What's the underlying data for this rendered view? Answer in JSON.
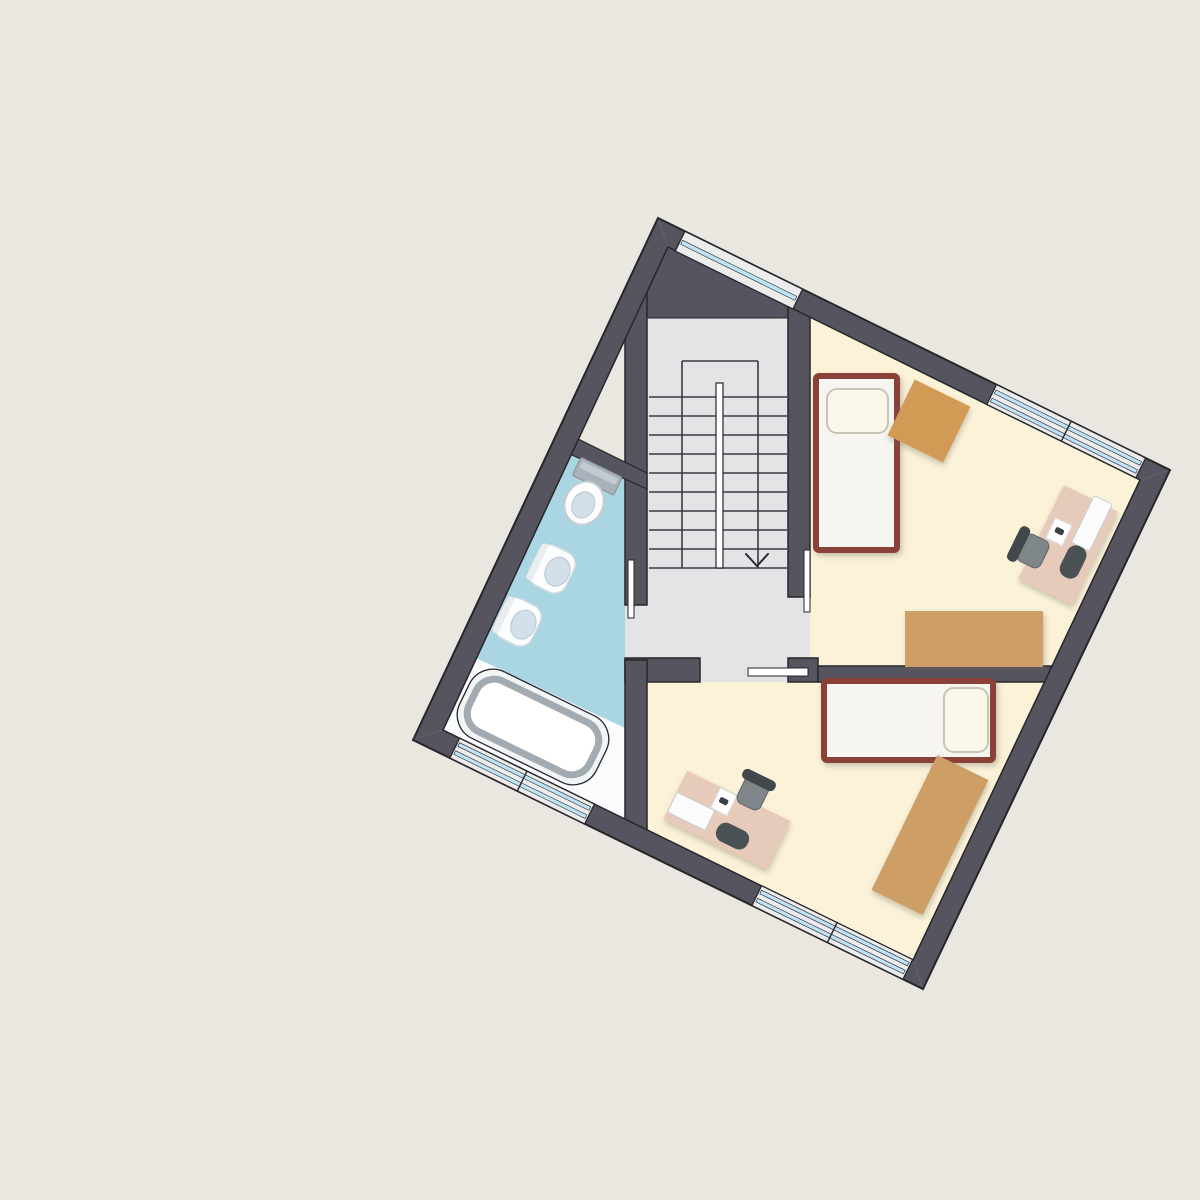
{
  "scene": {
    "width": 1200,
    "height": 1200,
    "background": "#eae7e1",
    "rotation_deg": 26
  },
  "palette": {
    "background": "#eae7e1",
    "wall": "#56545e",
    "outline": "#26262c",
    "hall_floor": "#e4e4e6",
    "stair_line": "#3a3a40",
    "bath_floor": "#aad6e4",
    "bath_platform": "#fafbfc",
    "bedroom_floor": "#fbf2d8",
    "window_band": "#ececec",
    "window_glass": "#bfe3f4",
    "bed_frame": "#8a4237",
    "bed_fill": "#f7f5f0",
    "pillow": "#fbf8ea",
    "cabinet_tan": "#cd9e66",
    "table_tan": "#d19a55",
    "desk_pink": "#e6cbbb",
    "chair_dark": "#41474a",
    "chair_seat": "#7e8689",
    "device_white": "#fbfbfb",
    "fixture_white": "#fcfdfe",
    "fixture_bowl": "#d3dfe9",
    "tank_gray": "#a9b2ba",
    "tub_rim": "#a3abb2"
  },
  "rooms": [
    {
      "id": "stair-hall"
    },
    {
      "id": "bathroom"
    },
    {
      "id": "bedroom-1"
    },
    {
      "id": "bedroom-2"
    }
  ],
  "shapes": [
    {
      "type": "polygon",
      "name": "hall-floor",
      "points": "647,318 779,318 810,334 810,682 625,682 625,605 647,605",
      "fill": "#e4e4e6"
    },
    {
      "type": "polygon",
      "name": "bathroom-floor",
      "points": "575,448 625,472 625,819 443,730",
      "fill": "#aad6e4"
    },
    {
      "type": "polygon",
      "name": "bathroom-platform",
      "points": "476,658 625,728 625,819 443,730",
      "fill": "#fafbfc"
    },
    {
      "type": "polygon",
      "name": "bedroom1-floor",
      "points": "810,316 1140,480 1049,672 810,672",
      "fill": "#fbf2d8"
    },
    {
      "type": "polygon",
      "name": "bedroom2-floor",
      "points": "647,682 1044,682 913,960 647,830",
      "fill": "#fbf2d8"
    },
    {
      "type": "line",
      "name": "stair-step",
      "x1": 649,
      "y1": 397,
      "x2": 787,
      "y2": 397,
      "stroke": "#3a3a40",
      "sw": 1.6
    },
    {
      "type": "line",
      "name": "stair-step",
      "x1": 649,
      "y1": 416,
      "x2": 787,
      "y2": 416,
      "stroke": "#3a3a40",
      "sw": 1.6
    },
    {
      "type": "line",
      "name": "stair-step",
      "x1": 649,
      "y1": 435,
      "x2": 787,
      "y2": 435,
      "stroke": "#3a3a40",
      "sw": 1.6
    },
    {
      "type": "line",
      "name": "stair-step",
      "x1": 649,
      "y1": 454,
      "x2": 787,
      "y2": 454,
      "stroke": "#3a3a40",
      "sw": 1.6
    },
    {
      "type": "line",
      "name": "stair-step",
      "x1": 649,
      "y1": 473,
      "x2": 787,
      "y2": 473,
      "stroke": "#3a3a40",
      "sw": 1.6
    },
    {
      "type": "line",
      "name": "stair-step",
      "x1": 649,
      "y1": 492,
      "x2": 787,
      "y2": 492,
      "stroke": "#3a3a40",
      "sw": 1.6
    },
    {
      "type": "line",
      "name": "stair-step",
      "x1": 649,
      "y1": 511,
      "x2": 787,
      "y2": 511,
      "stroke": "#3a3a40",
      "sw": 1.6
    },
    {
      "type": "line",
      "name": "stair-step",
      "x1": 649,
      "y1": 530,
      "x2": 787,
      "y2": 530,
      "stroke": "#3a3a40",
      "sw": 1.6
    },
    {
      "type": "line",
      "name": "stair-step",
      "x1": 649,
      "y1": 549,
      "x2": 787,
      "y2": 549,
      "stroke": "#3a3a40",
      "sw": 1.6
    },
    {
      "type": "line",
      "name": "stair-step",
      "x1": 649,
      "y1": 568,
      "x2": 787,
      "y2": 568,
      "stroke": "#3a3a40",
      "sw": 1.6
    },
    {
      "type": "line",
      "name": "stair-well-left",
      "x1": 682,
      "y1": 361,
      "x2": 682,
      "y2": 568,
      "stroke": "#3a3a40",
      "sw": 1.6
    },
    {
      "type": "line",
      "name": "stair-well-right",
      "x1": 758,
      "y1": 361,
      "x2": 758,
      "y2": 568,
      "stroke": "#3a3a40",
      "sw": 1.6
    },
    {
      "type": "line",
      "name": "stair-landing-edge",
      "x1": 682,
      "y1": 361,
      "x2": 758,
      "y2": 361,
      "stroke": "#3a3a40",
      "sw": 1.6
    },
    {
      "type": "rect",
      "name": "stair-handrail",
      "x": 716,
      "y": 383,
      "w": 7,
      "h": 185,
      "fill": "#ffffff",
      "stroke": "#26262c",
      "sw": 1.2
    },
    {
      "type": "polyline",
      "name": "stair-direction-arrow",
      "points": "746,554 757,566 768,554",
      "stroke": "#26262c",
      "sw": 2
    },
    {
      "type": "polygon",
      "name": "wall-top-corner-block",
      "points": "640,318 790,318 790,304 672,241 640,289",
      "fill": "#56545e",
      "stroke": "#26262c",
      "sw": 1
    },
    {
      "type": "rect",
      "name": "wall-hall-bathroom",
      "x": 625,
      "y": 294,
      "w": 22,
      "h": 311,
      "fill": "#56545e",
      "stroke": "#26262c",
      "sw": 1.5
    },
    {
      "type": "rect",
      "name": "wall-hall-bedroom1",
      "x": 788,
      "y": 304,
      "w": 22,
      "h": 293,
      "fill": "#56545e",
      "stroke": "#26262c",
      "sw": 1.5
    },
    {
      "type": "rect",
      "name": "wall-hall-bedroom2-left",
      "x": 625,
      "y": 658,
      "w": 75,
      "h": 24,
      "fill": "#56545e",
      "stroke": "#26262c",
      "sw": 1.5
    },
    {
      "type": "rect",
      "name": "wall-hall-bedroom2-corner",
      "x": 788,
      "y": 658,
      "w": 30,
      "h": 24,
      "fill": "#56545e",
      "stroke": "#26262c",
      "sw": 1.5
    },
    {
      "type": "rect",
      "name": "wall-bedroom1-bedroom2",
      "x": 818,
      "y": 666,
      "w": 247,
      "h": 16,
      "fill": "#56545e",
      "stroke": "#26262c",
      "sw": 1.5
    },
    {
      "type": "rect",
      "name": "wall-bathroom-bedroom2",
      "x": 625,
      "y": 660,
      "w": 22,
      "h": 175,
      "fill": "#56545e",
      "stroke": "#26262c",
      "sw": 1.5
    },
    {
      "type": "polygon",
      "name": "wall-bathroom-top",
      "points": "560,430 647,473 647,489 552,446",
      "fill": "#56545e",
      "stroke": "#26262c",
      "sw": 1.2
    },
    {
      "type": "polygon",
      "name": "outer-wall-top-right",
      "points": "658,218 1170,470 1140,480 668,247",
      "fill": "#56545e"
    },
    {
      "type": "polygon",
      "name": "outer-wall-right",
      "points": "1170,470 923,989 913,960 1140,480",
      "fill": "#56545e"
    },
    {
      "type": "polygon",
      "name": "outer-wall-bottom-left",
      "points": "923,989 413,740 443,730 913,960",
      "fill": "#56545e"
    },
    {
      "type": "polygon",
      "name": "outer-wall-top-left",
      "points": "413,740 658,218 668,247 443,730",
      "fill": "#56545e"
    },
    {
      "type": "polygon",
      "name": "outer-wall-outline",
      "points": "658,218 1170,470 923,989 413,740",
      "fill": "none",
      "stroke": "#26262c",
      "sw": 2
    },
    {
      "type": "polygon",
      "name": "inner-wall-outline",
      "points": "668,247 1140,480 913,960 443,730",
      "fill": "none",
      "stroke": "#26262c",
      "sw": 1.5
    },
    {
      "type": "polygon",
      "name": "window-hall-band",
      "points": "684.9,231.3 802.6,289.2 792.9,309.0 675.2,251.1",
      "fill": "#ececec",
      "stroke": "#26262c",
      "sw": 1.3
    },
    {
      "type": "polygon",
      "name": "window-hall-glass",
      "points": "682.7,240.3 796.8,296.4 794.8,300.4 680.7,244.3",
      "fill": "#bfe3f4",
      "stroke": "#26262c",
      "sw": 0.6
    },
    {
      "type": "polygon",
      "name": "window-bedroom1-band",
      "points": "996.5,384.6 1145.6,458.0 1135.9,477.8 986.8,404.4",
      "fill": "#ececec",
      "stroke": "#26262c",
      "sw": 1.3
    },
    {
      "type": "polygon",
      "name": "window-bedroom1-glass-outer",
      "points": "996.1,390.0 1141.6,461.6 1139.8,465.2 994.3,393.6",
      "fill": "#bfe3f4",
      "stroke": "#26262c",
      "sw": 0.6
    },
    {
      "type": "polygon",
      "name": "window-bedroom1-glass-inner",
      "points": "992.1,398.1 1137.6,469.7 1135.8,473.3 990.3,401.7",
      "fill": "#bfe3f4",
      "stroke": "#26262c",
      "sw": 0.6
    },
    {
      "type": "line",
      "name": "window-bedroom1-mullion",
      "x1": 1071.1,
      "y1": 421.3,
      "x2": 1061.4,
      "y2": 441.1,
      "stroke": "#26262c",
      "sw": 1.4
    },
    {
      "type": "polygon",
      "name": "window-bathroom-band",
      "points": "449.9,758.0 584.7,823.9 594.4,804.1 459.6,738.2",
      "fill": "#ececec",
      "stroke": "#26262c",
      "sw": 1.3
    },
    {
      "type": "polygon",
      "name": "window-bathroom-glass-outer",
      "points": "453.9,754.4 585.1,818.5 586.9,814.9 455.7,750.8",
      "fill": "#bfe3f4",
      "stroke": "#26262c",
      "sw": 0.6
    },
    {
      "type": "polygon",
      "name": "window-bathroom-glass-inner",
      "points": "457.8,746.3 589.0,810.4 590.8,806.8 459.6,742.7",
      "fill": "#bfe3f4",
      "stroke": "#26262c",
      "sw": 0.6
    },
    {
      "type": "line",
      "name": "window-bathroom-mullion",
      "x1": 517.3,
      "y1": 790.9,
      "x2": 527.0,
      "y2": 771.1,
      "stroke": "#26262c",
      "sw": 1.4
    },
    {
      "type": "polygon",
      "name": "window-bedroom2-band",
      "points": "751.9,905.5 903.0,979.3 912.7,959.5 761.6,885.7",
      "fill": "#ececec",
      "stroke": "#26262c",
      "sw": 1.3
    },
    {
      "type": "polygon",
      "name": "window-bedroom2-glass-outer",
      "points": "755.9,901.9 903.4,973.9 905.2,970.3 757.7,898.3",
      "fill": "#bfe3f4",
      "stroke": "#26262c",
      "sw": 0.6
    },
    {
      "type": "polygon",
      "name": "window-bedroom2-glass-inner",
      "points": "759.8,893.8 907.3,965.8 909.1,962.2 761.6,890.2",
      "fill": "#bfe3f4",
      "stroke": "#26262c",
      "sw": 0.6
    },
    {
      "type": "line",
      "name": "window-bedroom2-mullion",
      "x1": 827.4,
      "y1": 942.4,
      "x2": 837.1,
      "y2": 922.6,
      "stroke": "#26262c",
      "sw": 1.4
    },
    {
      "type": "rect",
      "name": "door-jamb-bathroom",
      "x": 628,
      "y": 560,
      "w": 6,
      "h": 58,
      "fill": "#ffffff",
      "stroke": "#26262c",
      "sw": 1
    },
    {
      "type": "rect",
      "name": "door-jamb-bedroom1",
      "x": 804,
      "y": 550,
      "w": 6,
      "h": 62,
      "fill": "#ffffff",
      "stroke": "#26262c",
      "sw": 1
    },
    {
      "type": "rect",
      "name": "door-leaf-bedroom2",
      "x": 748,
      "y": 668,
      "w": 60,
      "h": 8,
      "fill": "#ffffff",
      "stroke": "#26262c",
      "sw": 1
    },
    {
      "type": "rect",
      "name": "bed-1-frame",
      "x": 816,
      "y": 376,
      "w": 81,
      "h": 174,
      "rx": 3,
      "fill": "#f7f5f0",
      "stroke": "#8a4237",
      "sw": 6,
      "filter": "soft"
    },
    {
      "type": "rect",
      "name": "bed-1-pillow",
      "x": 827,
      "y": 389,
      "w": 61,
      "h": 44,
      "rx": 10,
      "fill": "#fbf8ea",
      "stroke": "#c9c4b5",
      "sw": 2
    },
    {
      "type": "rect",
      "name": "side-table-bedroom1",
      "x": 898,
      "y": 390,
      "w": 62,
      "h": 62,
      "rotate": [
        26,
        929,
        421
      ],
      "fill": "#d19a55",
      "filter": "soft"
    },
    {
      "type": "rect",
      "name": "wardrobe-bedroom1",
      "x": 905,
      "y": 611,
      "w": 138,
      "h": 56,
      "fill": "#cd9e66",
      "filter": "soft"
    },
    {
      "type": "rect",
      "name": "desk-bedroom1",
      "x": 1038,
      "y": 493,
      "w": 60,
      "h": 104,
      "rotate": [
        26,
        1068,
        545
      ],
      "fill": "#e6cbbb",
      "filter": "soft"
    },
    {
      "type": "rect",
      "name": "monitor-bedroom1",
      "x": 1081.9,
      "y": 497.3,
      "w": 20,
      "h": 52,
      "rx": 2,
      "rotate": [
        26,
        1091.9,
        523.3
      ],
      "fill": "#fbfbfb",
      "stroke": "#c9cdd1",
      "sw": 1
    },
    {
      "type": "rect",
      "name": "notepad-bedroom1",
      "x": 1049.9,
      "y": 520.7,
      "w": 18,
      "h": 22,
      "rotate": [
        26,
        1058.9,
        531.7
      ],
      "fill": "#ffffff",
      "stroke": "#dfe3e6",
      "sw": 1
    },
    {
      "type": "rect",
      "name": "mouse-bedroom1",
      "x": 1054.9,
      "y": 528.2,
      "w": 9,
      "h": 6,
      "rx": 2,
      "rotate": [
        26,
        1059.4,
        531.2
      ],
      "fill": "#3a4043"
    },
    {
      "type": "rect",
      "name": "bag-bedroom1",
      "x": 1063.1,
      "y": 545,
      "w": 20,
      "h": 34,
      "rx": 9,
      "rotate": [
        26,
        1073.1,
        562
      ],
      "fill": "#4a5154"
    },
    {
      "type": "rect",
      "name": "chair-seat-bedroom1",
      "x": 1020,
      "y": 536,
      "w": 26,
      "h": 30,
      "rx": 7,
      "rotate": [
        26,
        1033,
        551
      ],
      "fill": "#7e8689",
      "stroke": "#5d6568",
      "sw": 1
    },
    {
      "type": "rect",
      "name": "chair-back-bedroom1",
      "x": 1013.1,
      "y": 525,
      "w": 11,
      "h": 38,
      "rx": 5,
      "rotate": [
        26,
        1018.6,
        544
      ],
      "fill": "#41474a"
    },
    {
      "type": "rect",
      "name": "bed-2-frame",
      "x": 824,
      "y": 681,
      "w": 169,
      "h": 79,
      "rx": 3,
      "fill": "#f7f5f0",
      "stroke": "#8a4237",
      "sw": 6,
      "filter": "soft"
    },
    {
      "type": "rect",
      "name": "bed-2-pillow",
      "x": 944,
      "y": 688,
      "w": 44,
      "h": 64,
      "rx": 10,
      "fill": "#fbf8ea",
      "stroke": "#c9c4b5",
      "sw": 2
    },
    {
      "type": "rect",
      "name": "wardrobe-bedroom2",
      "x": 901.5,
      "y": 760,
      "w": 57,
      "h": 150,
      "rotate": [
        26,
        930,
        835
      ],
      "fill": "#cd9e66",
      "filter": "soft"
    },
    {
      "type": "rect",
      "name": "desk-bedroom2",
      "x": 669.5,
      "y": 793,
      "w": 115,
      "h": 54,
      "rotate": [
        26,
        727,
        820
      ],
      "fill": "#e6cbbb",
      "filter": "soft"
    },
    {
      "type": "rect",
      "name": "monitor-bedroom2",
      "x": 670.1,
      "y": 800.4,
      "w": 42,
      "h": 22,
      "rx": 2,
      "rotate": [
        26,
        691.1,
        811.4
      ],
      "fill": "#fbfbfb",
      "stroke": "#c9cdd1",
      "sw": 1
    },
    {
      "type": "rect",
      "name": "notepad-bedroom2",
      "x": 714.7,
      "y": 790.7,
      "w": 18,
      "h": 22,
      "rotate": [
        26,
        723.7,
        801.7
      ],
      "fill": "#ffffff",
      "stroke": "#dfe3e6",
      "sw": 1
    },
    {
      "type": "rect",
      "name": "mouse-bedroom2",
      "x": 719.2,
      "y": 798.2,
      "w": 9,
      "h": 6,
      "rx": 2,
      "rotate": [
        26,
        723.7,
        801.2
      ],
      "fill": "#3a4043"
    },
    {
      "type": "rect",
      "name": "bag-bedroom2",
      "x": 715.5,
      "y": 826.1,
      "w": 34,
      "h": 20,
      "rx": 9,
      "rotate": [
        26,
        732.5,
        836.1
      ],
      "fill": "#4a5154"
    },
    {
      "type": "rect",
      "name": "chair-seat-bedroom2",
      "x": 740,
      "y": 778,
      "w": 26,
      "h": 30,
      "rx": 7,
      "rotate": [
        26,
        753,
        793
      ],
      "fill": "#7e8689",
      "stroke": "#5d6568",
      "sw": 1
    },
    {
      "type": "rect",
      "name": "chair-back-bedroom2",
      "x": 741,
      "y": 774.5,
      "w": 36,
      "h": 11,
      "rx": 5,
      "rotate": [
        26,
        759,
        780
      ],
      "fill": "#41474a"
    },
    {
      "type": "group",
      "name": "toilet",
      "rotate": [
        26,
        592,
        487
      ],
      "children": [
        {
          "type": "rect",
          "name": "toilet-tank",
          "x": 569,
          "y": 465,
          "w": 46,
          "h": 20,
          "rx": 2,
          "fill": "#a9b2ba",
          "stroke": "#888f96",
          "sw": 1
        },
        {
          "type": "rect",
          "name": "toilet-tank-lid",
          "x": 572,
          "y": 468,
          "w": 40,
          "h": 7,
          "rx": 2,
          "fill": "#c2cad1"
        },
        {
          "type": "ellipse",
          "name": "toilet-bowl",
          "cx": 592,
          "cy": 505,
          "rx": 19,
          "ry": 22,
          "fill": "#fdfdfd",
          "stroke": "#c6cdd3",
          "sw": 2
        },
        {
          "type": "ellipse",
          "name": "toilet-bowl-inner",
          "cx": 592,
          "cy": 507,
          "rx": 11,
          "ry": 13.5,
          "fill": "#d3dfe9",
          "stroke": "#b5c6d4",
          "sw": 1
        }
      ]
    },
    {
      "type": "group",
      "name": "bidet-1",
      "rotate": [
        26,
        552,
        569
      ],
      "children": [
        {
          "type": "rect",
          "name": "bidet-1-body",
          "x": 532,
          "y": 547,
          "w": 40,
          "h": 44,
          "rx": 13,
          "fill": "#fcfdfe",
          "stroke": "#d4d9dd",
          "sw": 1.5
        },
        {
          "type": "rect",
          "name": "bidet-1-back",
          "x": 532,
          "y": 549,
          "w": 7,
          "h": 40,
          "rx": 3,
          "fill": "#e8edf0"
        },
        {
          "type": "ellipse",
          "name": "bidet-1-bowl",
          "cx": 558,
          "cy": 569,
          "rx": 12,
          "ry": 15,
          "fill": "#d3dfe9",
          "stroke": "#b5c6d4",
          "sw": 1
        }
      ]
    },
    {
      "type": "group",
      "name": "bidet-2",
      "rotate": [
        26,
        518,
        622
      ],
      "children": [
        {
          "type": "rect",
          "name": "bidet-2-body",
          "x": 498,
          "y": 600,
          "w": 40,
          "h": 44,
          "rx": 13,
          "fill": "#fcfdfe",
          "stroke": "#d4d9dd",
          "sw": 1.5
        },
        {
          "type": "rect",
          "name": "bidet-2-back",
          "x": 498,
          "y": 602,
          "w": 7,
          "h": 40,
          "rx": 3,
          "fill": "#e8edf0"
        },
        {
          "type": "ellipse",
          "name": "bidet-2-bowl",
          "cx": 524,
          "cy": 622,
          "rx": 12,
          "ry": 15,
          "fill": "#d3dfe9",
          "stroke": "#b5c6d4",
          "sw": 1
        }
      ]
    },
    {
      "type": "group",
      "name": "bathtub",
      "rotate": [
        26,
        533,
        727
      ],
      "children": [
        {
          "type": "rect",
          "name": "bathtub-outer",
          "x": 457,
          "y": 690,
          "w": 152,
          "h": 74,
          "rx": 26,
          "fill": "#f2f5f6",
          "stroke": "#26262c",
          "sw": 1.3
        },
        {
          "type": "rect",
          "name": "bathtub-basin",
          "x": 466,
          "y": 699,
          "w": 134,
          "h": 56,
          "rx": 20,
          "fill": "#ffffff",
          "stroke": "#a3abb2",
          "sw": 7
        }
      ]
    }
  ]
}
